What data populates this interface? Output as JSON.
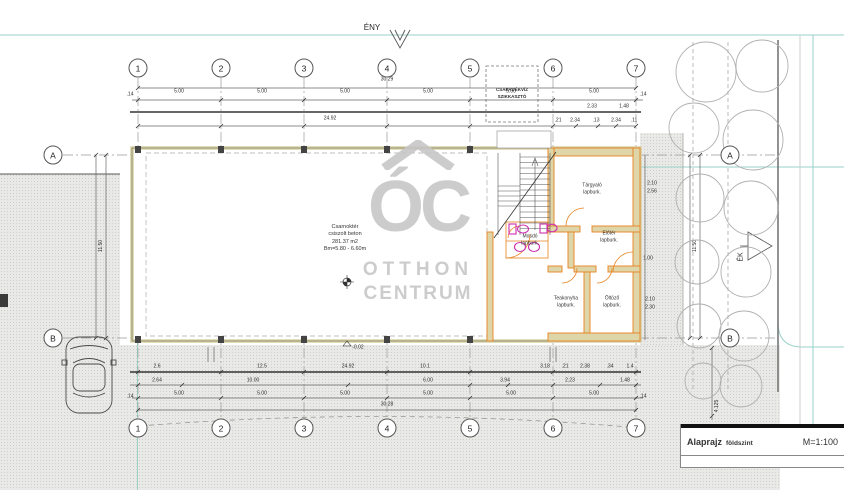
{
  "compass": {
    "north_label": "ÉNY",
    "east_label": "ÉK"
  },
  "grid": {
    "cols": [
      "1",
      "2",
      "3",
      "4",
      "5",
      "6",
      "7"
    ],
    "rows": [
      "A",
      "B"
    ]
  },
  "note_box": {
    "line1": "CSAPADÉKVÍZ",
    "line2": "SZIKKASZTÓ"
  },
  "hall": {
    "name": "Csarnoktér",
    "finish": "csiszolt beton",
    "area": "281.37 m2",
    "height": "Bm=5.80 - 6.60m",
    "level_main": "+0.00",
    "level_low": "-0.02",
    "beam": "IPE 240"
  },
  "rooms": [
    {
      "name": "Tárgyaló",
      "finish": "lapburk."
    },
    {
      "name": "Mosdó",
      "finish": "lapburk."
    },
    {
      "name": "Előtér",
      "finish": "lapburk."
    },
    {
      "name": "Teakonyha",
      "finish": "lapburk."
    },
    {
      "name": "Öltöző",
      "finish": "lapburk."
    }
  ],
  "dims": {
    "top_total": "30.29",
    "span": "5.00",
    "end": ".14",
    "top_sub_total": "24.92",
    "top_small": [
      "2.33",
      "1.48",
      ".21",
      "2.34",
      ".13",
      "2.34",
      ".11"
    ],
    "bottom_row1": [
      "2.6",
      "12.5",
      "24.92",
      "10.1"
    ],
    "bottom_small": [
      "3.18",
      ".21",
      "2.38",
      ".34",
      "1.4"
    ],
    "bottom_row2": [
      "2.64",
      "10.00",
      "6.00",
      "3.94",
      "2.23",
      "1.48"
    ],
    "bottom_total": "30.28",
    "right_small": [
      "2.10",
      "2.56",
      "1.00",
      "2.10",
      "2.30"
    ],
    "left_vertical": "11.50",
    "right_vertical": "11.50",
    "right_vertical_2": "4.125"
  },
  "watermark": {
    "logo": "ÓC",
    "line1": "OTTHON",
    "line2": "CENTRUM"
  },
  "titleblock": {
    "title": "Alaprajz",
    "subtitle": "földszint",
    "scale": "M=1:100"
  },
  "colors": {
    "wall_accent": "#e8821e",
    "fixture": "#cc2fb0",
    "utility_line": "#9ad2c8",
    "hall_wall": "#d8d2a6"
  }
}
